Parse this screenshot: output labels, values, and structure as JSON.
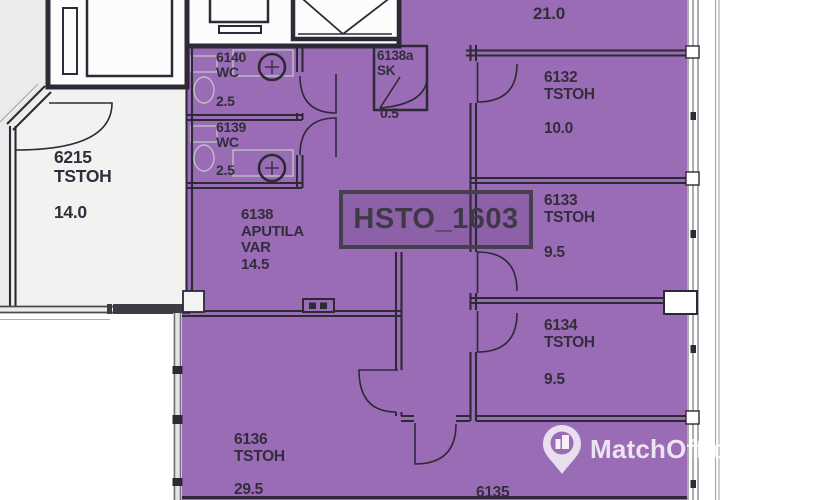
{
  "plan": {
    "label": "HSTO_1603",
    "rooms": [
      {
        "number": "6215",
        "type": "TSTOH",
        "area": "14.0"
      },
      {
        "number": "6140",
        "type": "WC",
        "area": "2.5"
      },
      {
        "number": "6139",
        "type": "WC",
        "area": "2.5"
      },
      {
        "number": "6138a",
        "type": "SK",
        "area": "0.5"
      },
      {
        "number": "6138",
        "type": "APUTILA",
        "type2": "VAR",
        "area": "14.5"
      },
      {
        "number": "6132",
        "type": "TSTOH",
        "area": "10.0"
      },
      {
        "number": "6133",
        "type": "TSTOH",
        "area": "9.5"
      },
      {
        "number": "6134",
        "type": "TSTOH",
        "area": "9.5"
      },
      {
        "number": "6136",
        "type": "TSTOH",
        "area": "29.5"
      },
      {
        "number": "6135"
      },
      {
        "area": "21.0"
      }
    ],
    "colors": {
      "highlight": "#9a6cb5",
      "wall": "#2e2937",
      "background_outside": "#ebebeb"
    }
  },
  "watermark": {
    "brand": "MatchOffice"
  }
}
